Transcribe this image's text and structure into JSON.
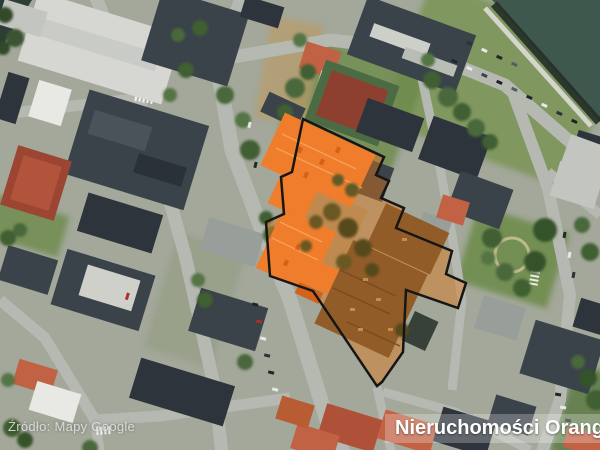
{
  "overlay": {
    "attribution": "Źródło: Mapy Google",
    "brand_watermark": "Nieruchomości Orange"
  },
  "colors": {
    "highlight_fill": "#e0761a",
    "highlight_outline": "#161616",
    "roof_orange": "#f07d2b",
    "roof_orange_dark": "#d4621a",
    "roof_brown": "#925c28",
    "water": "#3f584e",
    "street": "#b6b9b2"
  }
}
